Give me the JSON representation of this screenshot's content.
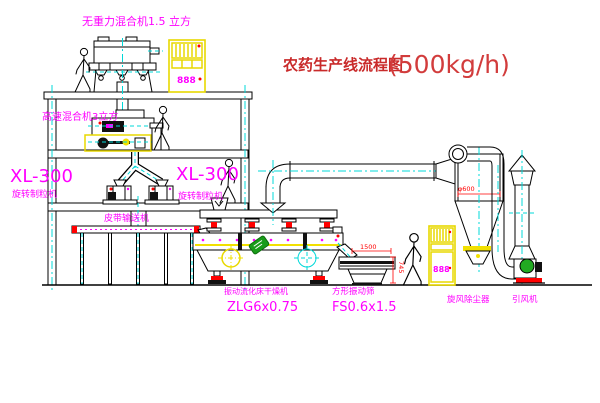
{
  "title": {
    "text": "农药生产线流程图",
    "capacity": "(500kg/h)"
  },
  "equipment": {
    "gravity_mixer_label": "无重力混合机1.5 立方",
    "high_speed_mixer_label": "高速混合机3立方",
    "granulator_left": {
      "model": "XL-300",
      "name": "旋转制粒机"
    },
    "granulator_right": {
      "model": "XL-300",
      "name": "旋转制粒机"
    },
    "belt_conveyor_label": "皮带输送机",
    "dryer": {
      "name": "振动流化床干燥机",
      "model": "ZLG6x0.75"
    },
    "sieve": {
      "name": "方形振动筛",
      "model": "FS0.6x1.5"
    },
    "cyclone_label": "旋风除尘器",
    "fan_label": "引风机"
  },
  "dimensions": {
    "sieve_length": "1500",
    "sieve_height": "745",
    "cyclone_diameter": "φ600"
  },
  "cabinets": {
    "upper_display": "888",
    "lower_display": "888"
  },
  "colors": {
    "label_magenta": "#ff00ff",
    "title_red": "#c92a2a",
    "dimension_red": "#ff0000",
    "centerline_cyan": "#00d8d8",
    "highlight_yellow": "#f2e000",
    "stamp_green": "#1a9c1a",
    "line_black": "#000000",
    "background": "#ffffff"
  }
}
